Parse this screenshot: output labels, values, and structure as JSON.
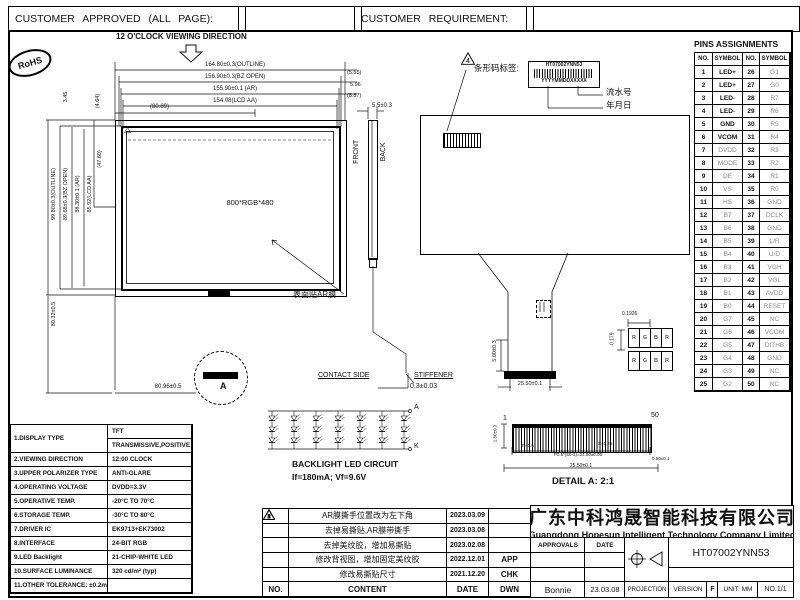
{
  "header": {
    "approved": "CUSTOMER APPROVED (ALL PAGE):",
    "requirement": "CUSTOMER REQUIREMENT:"
  },
  "badges": {
    "rohs": "RoHS"
  },
  "drawing": {
    "viewing_direction": "12 O'CLOCK VIEWING DIRECTION",
    "panel_text": "800*RGB*480",
    "ar_film_label": "表面贴AR膜",
    "front": "FRONT",
    "back": "BACK",
    "contact_side": "CONTACT SIDE",
    "stiffener": "STIFFENER",
    "stiffener_thk": "0.3±0.03",
    "detail_mark": "A",
    "dims": {
      "outline_w": "164.80±0.3(OUTLINE)",
      "bz_w": "156.90±0.3(BZ OPEN)",
      "ar_w": "155.90±0.1 (AR)",
      "aa_w": "154.08(LCD AA)",
      "half_w": "(80.89)",
      "r1": "(5.55)",
      "r2": "5.96",
      "r3": "(8.87)",
      "thickness": "5.5±0.3",
      "outline_h": "99.80±0.3(OUTLINE)",
      "bz_h": "89.68±0.3(BZ OPEN)",
      "ar_h": "88.30±0.1 (AR)",
      "aa_h": "85.92(LCD AA)",
      "half_h": "(47.60)",
      "t1": "3.45",
      "t2": "(4.64)",
      "left_bottom": "80.32±0.5",
      "bottom": "80.96±0.5",
      "fpc_h": "5.00±0.3",
      "fpc_w": "25.50±0.1"
    },
    "barcode": {
      "label": "条形码标签:",
      "model": "HT07002YNN53",
      "date_code": "YYYYMMDDXXXXX",
      "serial_note": "流水号",
      "date_note": "年月日",
      "rev_mark": "4"
    },
    "pixel": {
      "cells": [
        "R",
        "G",
        "B",
        "R"
      ],
      "width": "0.1926",
      "height": "0.179"
    }
  },
  "backlight": {
    "title": "BACKLIGHT LED CIRCUIT",
    "spec": "If=180mA; Vf=9.6V",
    "anode": "A",
    "cathode": "K",
    "rows": 3,
    "cols": 7
  },
  "detail_a": {
    "pin_first": "1",
    "pin_last": "50",
    "height": "1.80±0.3",
    "pin_width": "P=0.5",
    "space": "S=0.25",
    "pitch_total": "P0.5*(50-1)=24.50±0.05",
    "edge": "0.50±0.1",
    "total_width": "25.50±0.1",
    "title": "DETAIL A: 2:1"
  },
  "pins": {
    "title": "PINS ASSIGNMENTS",
    "headers": [
      "NO.",
      "SYMBOL",
      "NO.",
      "SYMBOL"
    ],
    "rows": [
      [
        "1",
        "LED+",
        "26",
        "G1"
      ],
      [
        "2",
        "LED+",
        "27",
        "G0"
      ],
      [
        "3",
        "LED-",
        "28",
        "R7"
      ],
      [
        "4",
        "LED-",
        "29",
        "R6"
      ],
      [
        "5",
        "GND",
        "30",
        "R5"
      ],
      [
        "6",
        "VCOM",
        "31",
        "R4"
      ],
      [
        "7",
        "DVDD",
        "32",
        "R3"
      ],
      [
        "8",
        "MODE",
        "33",
        "R2"
      ],
      [
        "9",
        "DE",
        "34",
        "R1"
      ],
      [
        "10",
        "VS",
        "35",
        "R0"
      ],
      [
        "11",
        "HS",
        "36",
        "GND"
      ],
      [
        "12",
        "B7",
        "37",
        "DCLK"
      ],
      [
        "13",
        "B6",
        "38",
        "GND"
      ],
      [
        "14",
        "B5",
        "39",
        "L/R"
      ],
      [
        "15",
        "B4",
        "40",
        "U/D"
      ],
      [
        "16",
        "B3",
        "41",
        "VGH"
      ],
      [
        "17",
        "B2",
        "42",
        "VGL"
      ],
      [
        "18",
        "B1",
        "43",
        "AVDD"
      ],
      [
        "19",
        "B0",
        "44",
        "RESET"
      ],
      [
        "20",
        "G7",
        "45",
        "NC"
      ],
      [
        "21",
        "G6",
        "46",
        "VCOM"
      ],
      [
        "22",
        "G5",
        "47",
        "DITHB"
      ],
      [
        "23",
        "G4",
        "48",
        "GND"
      ],
      [
        "24",
        "G3",
        "49",
        "NC"
      ],
      [
        "25",
        "G2",
        "50",
        "NC"
      ]
    ]
  },
  "specs": {
    "rows": [
      {
        "label": "1.DISPLAY TYPE",
        "values": [
          "TFT",
          "TRANSMISSIVE,POSITIVE"
        ]
      },
      {
        "label": "2.VIEWING DIRECTION",
        "values": [
          "12:00 CLOCK"
        ]
      },
      {
        "label": "3.UPPER POLARIZER TYPE",
        "values": [
          "ANTI-GLARE"
        ]
      },
      {
        "label": "4.OPERATING VOLTAGE",
        "values": [
          "DVDD=3.3V"
        ]
      },
      {
        "label": "5.OPERATIVE TEMP.",
        "values": [
          "-20°C TO 70°C"
        ]
      },
      {
        "label": "6.STORAGE TEMP.",
        "values": [
          "-30°C TO 80°C"
        ]
      },
      {
        "label": "7.DRIVER IC",
        "values": [
          "EK9713+EK73002"
        ]
      },
      {
        "label": "8.INTERFACE",
        "values": [
          "24-BIT RGB"
        ]
      },
      {
        "label": "9.LED Backlight",
        "values": [
          "21-CHIP-WHITE LED"
        ]
      },
      {
        "label": "10.SURFACE LUMINANCE",
        "values": [
          "320 cd/m² (typ)"
        ]
      },
      {
        "label": "11.OTHER TOLERANCE: ±0.2mm",
        "values": [
          ""
        ]
      }
    ]
  },
  "revisions": {
    "rows": [
      {
        "no": "5",
        "content": "AR膜撕手位置改为左下角",
        "date": "2023.03.09",
        "side": ""
      },
      {
        "no": "4",
        "content": "去掉易撕贴,AR膜带撕手",
        "date": "2023.03.08",
        "side": ""
      },
      {
        "no": "3",
        "content": "去掉美纹胶，增加易撕贴",
        "date": "2023.02.08",
        "side": ""
      },
      {
        "no": "2",
        "content": "修改背视图，增加固定美纹胶",
        "date": "2022.12.01",
        "side": "APP"
      },
      {
        "no": "1",
        "content": "修改易撕贴尺寸",
        "date": "2021.12.20",
        "side": "CHK"
      }
    ],
    "footer": {
      "no": "NO.",
      "content": "CONTENT",
      "date": "DATE",
      "side": "DWN"
    }
  },
  "title_block": {
    "company_cn": "广东中科鸿晟智能科技有限公司",
    "company_en": "Guangdong Hopesun Intelligent Technology Company Limited",
    "approvals": "APPROVALS",
    "date": "DATE",
    "drawn_by": "Bonnie",
    "drawn_date": "23.03.08",
    "projection": "PROJECTION",
    "model": "HT07002YNN53",
    "version_label": "VERSION",
    "version": "F",
    "unit": "UNIT: MM",
    "sheet": "NO.1/1"
  }
}
